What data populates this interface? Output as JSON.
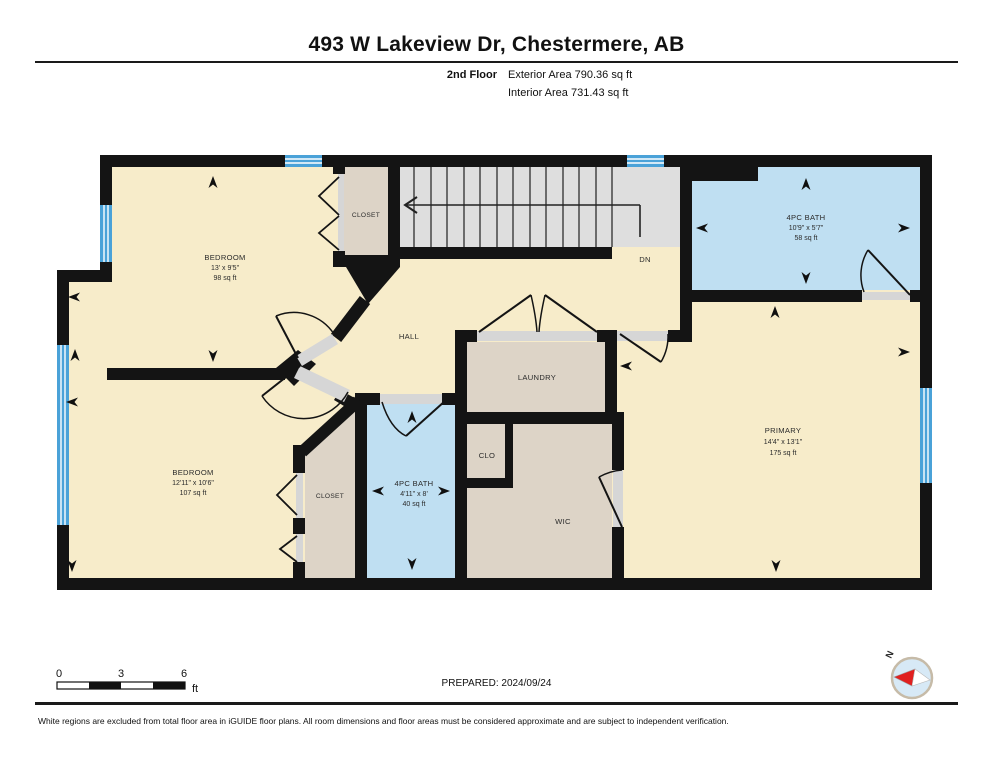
{
  "header": {
    "title": "493 W Lakeview Dr, Chestermere, AB",
    "floor_label": "2nd Floor",
    "exterior_area": "Exterior Area 790.36 sq ft",
    "interior_area": "Interior Area 731.43 sq ft"
  },
  "rooms": {
    "bedroom_top": {
      "name": "BEDROOM",
      "dims": "13' x 9'5\"",
      "area": "98 sq ft"
    },
    "closet_top": {
      "name": "CLOSET"
    },
    "stairs": {
      "label": "DN"
    },
    "bath_top": {
      "name": "4PC BATH",
      "dims": "10'9\" x 5'7\"",
      "area": "58 sq ft"
    },
    "hall": {
      "name": "HALL"
    },
    "laundry": {
      "name": "LAUNDRY"
    },
    "primary": {
      "name": "PRIMARY",
      "dims": "14'4\" x 13'1\"",
      "area": "175 sq ft"
    },
    "bedroom_bottom": {
      "name": "BEDROOM",
      "dims": "12'11\" x 10'6\"",
      "area": "107 sq ft"
    },
    "closet_bottom": {
      "name": "CLOSET"
    },
    "bath_bottom": {
      "name": "4PC BATH",
      "dims": "4'11\" x 8'",
      "area": "40 sq ft"
    },
    "clo": {
      "name": "CLO"
    },
    "wic": {
      "name": "WIC"
    }
  },
  "scale_bar": {
    "ticks": [
      "0",
      "3",
      "6"
    ],
    "unit": "ft"
  },
  "footer": {
    "prepared": "PREPARED: 2024/09/24",
    "compass_label": "N",
    "disclaimer": "White regions are excluded from total floor area in iGUIDE floor plans. All room dimensions and floor areas must be considered approximate and are subject to independent verification."
  },
  "colors": {
    "wall": "#141414",
    "room_fill": "#f7ecca",
    "bath_fill": "#bfdff2",
    "closet_fill": "#ddd4c7",
    "stairs_fill": "#dedede",
    "window": "#4aa2d8",
    "door_sill": "#d6d6d6",
    "compass_red": "#e02020"
  }
}
